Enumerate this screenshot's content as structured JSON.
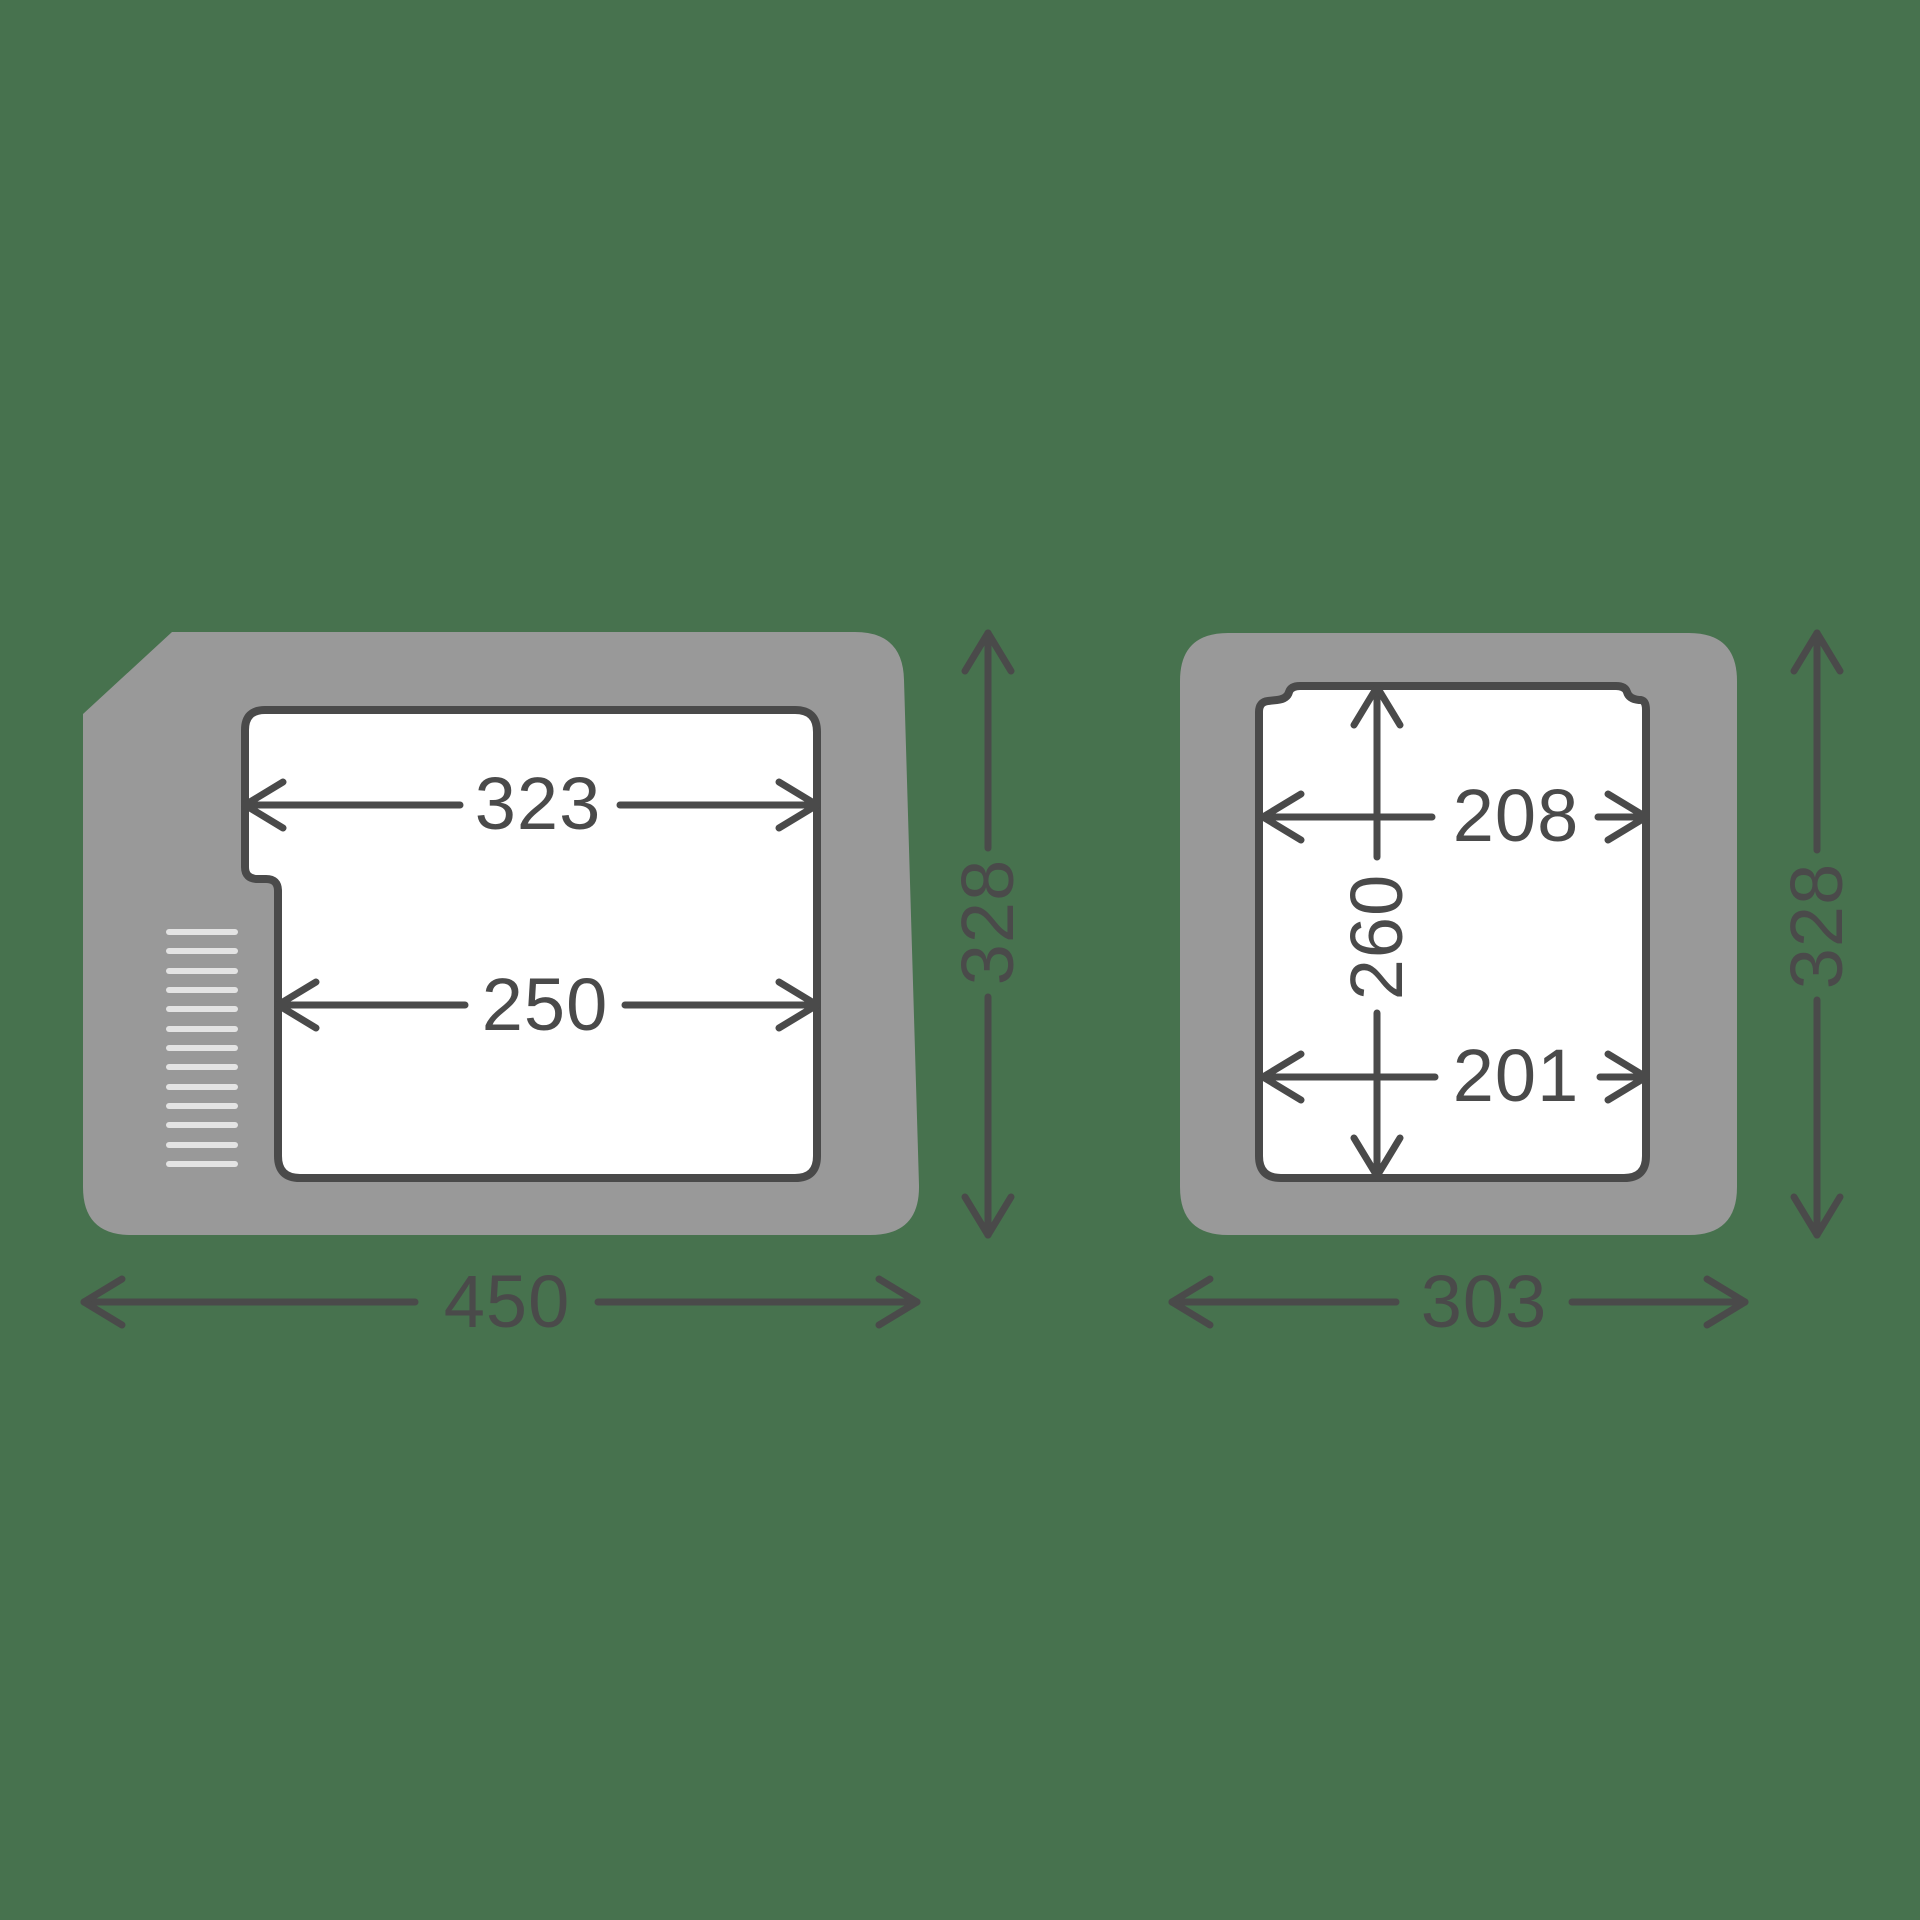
{
  "colors": {
    "background": "#47724E",
    "body_gray": "#999999",
    "cavity_white": "#FFFFFF",
    "line_dark": "#4A4A4A",
    "vent_light": "#E3E3E3"
  },
  "left_view": {
    "inner_top_width": "323",
    "inner_bottom_width": "250",
    "outer_width": "450",
    "outer_height": "328"
  },
  "right_view": {
    "inner_top_width": "208",
    "inner_height": "260",
    "inner_bottom_width": "201",
    "outer_width": "303",
    "outer_height": "328"
  }
}
